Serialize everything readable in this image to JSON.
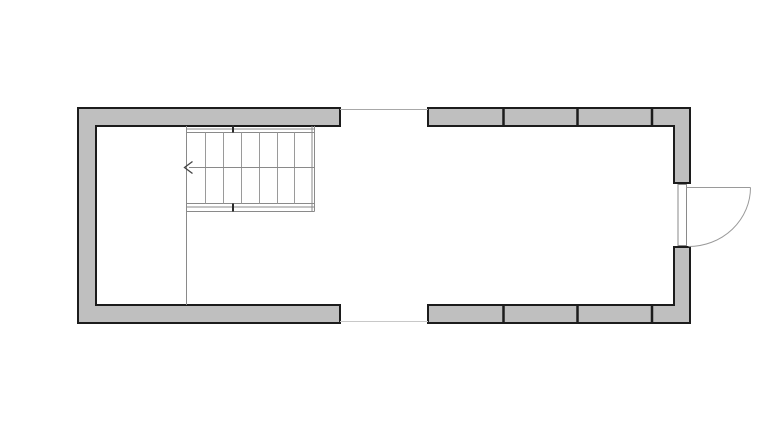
{
  "page": {
    "background": "#ffffff",
    "width": 768,
    "height": 431
  },
  "plan": {
    "name": "floor-plan-with-stair-and-entry-door",
    "viewbox": "0 0 768 431",
    "colors": {
      "wall_fill": "#bfbfbf",
      "wall_outline": "#1c1c1c",
      "stair_line": "#8a8a8a",
      "tread_line": "#9a9a9a",
      "door_line": "#9a9a9a",
      "opening_line_top": "#a8a8a8",
      "opening_line_bottom": "#c8c8c8",
      "tick": "#2a2a2a",
      "arrow": "#444444"
    },
    "summary": {
      "stair_treads": 7,
      "stair_direction": "arrow-pointing-left",
      "wall_panel_dividers_top": 3,
      "wall_panel_dividers_bottom": 3,
      "door": "right-wall-outward-swing-with-quarter-arc",
      "middle_wall_opening": "passage-between-left-and-right-sections"
    },
    "shapes": [
      {
        "kind": "path",
        "name": "wall-left-c-shape",
        "d": "M340,108 L78,108 L78,323 L340,323 L340,305 L96,305 L96,126 L340,126 Z",
        "fill": "#bfbfbf",
        "stroke": "#1c1c1c",
        "width": 2
      },
      {
        "kind": "path",
        "name": "wall-top-right-run",
        "d": "M428,108 L690,108 L690,183 L674,183 L674,126 L428,126 Z",
        "fill": "#bfbfbf",
        "stroke": "#1c1c1c",
        "width": 2
      },
      {
        "kind": "path",
        "name": "wall-bottom-right-run",
        "d": "M428,323 L690,323 L690,247 L674,247 L674,305 L428,305 Z",
        "fill": "#bfbfbf",
        "stroke": "#1c1c1c",
        "width": 2
      },
      {
        "kind": "line",
        "name": "wall-mullion-top-1",
        "x1": 503.5,
        "y1": 108,
        "x2": 503.5,
        "y2": 126,
        "stroke": "#1c1c1c",
        "width": 2.5
      },
      {
        "kind": "line",
        "name": "wall-mullion-top-2",
        "x1": 577.5,
        "y1": 108,
        "x2": 577.5,
        "y2": 126,
        "stroke": "#1c1c1c",
        "width": 2.5
      },
      {
        "kind": "line",
        "name": "wall-mullion-top-3",
        "x1": 652,
        "y1": 108,
        "x2": 652,
        "y2": 126,
        "stroke": "#1c1c1c",
        "width": 2.5
      },
      {
        "kind": "line",
        "name": "wall-mullion-bottom-1",
        "x1": 503.5,
        "y1": 305,
        "x2": 503.5,
        "y2": 323,
        "stroke": "#1c1c1c",
        "width": 2.5
      },
      {
        "kind": "line",
        "name": "wall-mullion-bottom-2",
        "x1": 577.5,
        "y1": 305,
        "x2": 577.5,
        "y2": 323,
        "stroke": "#1c1c1c",
        "width": 2.5
      },
      {
        "kind": "line",
        "name": "wall-mullion-bottom-3",
        "x1": 652,
        "y1": 305,
        "x2": 652,
        "y2": 323,
        "stroke": "#1c1c1c",
        "width": 2.5
      },
      {
        "kind": "line",
        "name": "opening-sill-line-top",
        "x1": 340,
        "y1": 109.5,
        "x2": 428,
        "y2": 109.5,
        "stroke": "#a8a8a8",
        "width": 1
      },
      {
        "kind": "line",
        "name": "opening-sill-line-bottom",
        "x1": 340,
        "y1": 321.5,
        "x2": 428,
        "y2": 321.5,
        "stroke": "#c8c8c8",
        "width": 1
      },
      {
        "kind": "line",
        "name": "stair-left-edge-and-partition-line",
        "x1": 186.5,
        "y1": 126,
        "x2": 186.5,
        "y2": 305,
        "stroke": "#8a8a8a",
        "width": 1
      },
      {
        "kind": "line",
        "name": "stair-right-edge-inner",
        "x1": 312,
        "y1": 126,
        "x2": 312,
        "y2": 211.5,
        "stroke": "#8a8a8a",
        "width": 1
      },
      {
        "kind": "line",
        "name": "stair-right-edge-outer",
        "x1": 314.5,
        "y1": 126,
        "x2": 314.5,
        "y2": 211.5,
        "stroke": "#8a8a8a",
        "width": 1
      },
      {
        "kind": "line",
        "name": "stair-top-stringer-outer",
        "x1": 186.5,
        "y1": 129,
        "x2": 314.5,
        "y2": 129,
        "stroke": "#8a8a8a",
        "width": 1
      },
      {
        "kind": "line",
        "name": "stair-top-stringer-inner",
        "x1": 186.5,
        "y1": 132.5,
        "x2": 314.5,
        "y2": 132.5,
        "stroke": "#8a8a8a",
        "width": 1
      },
      {
        "kind": "line",
        "name": "stair-bottom-stringer-inner",
        "x1": 186.5,
        "y1": 203.5,
        "x2": 314.5,
        "y2": 203.5,
        "stroke": "#8a8a8a",
        "width": 1
      },
      {
        "kind": "line",
        "name": "stair-bottom-stringer-outer",
        "x1": 186.5,
        "y1": 207,
        "x2": 314.5,
        "y2": 207,
        "stroke": "#8a8a8a",
        "width": 1
      },
      {
        "kind": "line",
        "name": "stair-bottom-edge",
        "x1": 186.5,
        "y1": 211.5,
        "x2": 314.5,
        "y2": 211.5,
        "stroke": "#8a8a8a",
        "width": 1
      },
      {
        "kind": "line",
        "name": "stair-tread-1",
        "x1": 205.5,
        "y1": 132.5,
        "x2": 205.5,
        "y2": 203.5,
        "stroke": "#9a9a9a",
        "width": 1
      },
      {
        "kind": "line",
        "name": "stair-tread-2",
        "x1": 223.5,
        "y1": 132.5,
        "x2": 223.5,
        "y2": 203.5,
        "stroke": "#9a9a9a",
        "width": 1
      },
      {
        "kind": "line",
        "name": "stair-tread-3",
        "x1": 241.5,
        "y1": 132.5,
        "x2": 241.5,
        "y2": 203.5,
        "stroke": "#9a9a9a",
        "width": 1
      },
      {
        "kind": "line",
        "name": "stair-tread-4",
        "x1": 259.5,
        "y1": 132.5,
        "x2": 259.5,
        "y2": 203.5,
        "stroke": "#9a9a9a",
        "width": 1
      },
      {
        "kind": "line",
        "name": "stair-tread-5",
        "x1": 277.5,
        "y1": 132.5,
        "x2": 277.5,
        "y2": 203.5,
        "stroke": "#9a9a9a",
        "width": 1
      },
      {
        "kind": "line",
        "name": "stair-tread-6",
        "x1": 294.5,
        "y1": 132.5,
        "x2": 294.5,
        "y2": 203.5,
        "stroke": "#9a9a9a",
        "width": 1
      },
      {
        "kind": "line",
        "name": "stair-walk-line",
        "x1": 189,
        "y1": 167.5,
        "x2": 314.5,
        "y2": 167.5,
        "stroke": "#8a8a8a",
        "width": 1
      },
      {
        "kind": "path",
        "name": "stair-direction-arrow-icon",
        "d": "M192.5,161.5 L184.5,167.5 L192.5,173.5",
        "fill": "none",
        "stroke": "#444444",
        "width": 1.3
      },
      {
        "kind": "line",
        "name": "stair-break-tick-top",
        "x1": 233,
        "y1": 125,
        "x2": 233,
        "y2": 132.5,
        "stroke": "#2a2a2a",
        "width": 2
      },
      {
        "kind": "line",
        "name": "stair-break-tick-bottom",
        "x1": 233,
        "y1": 203.5,
        "x2": 233,
        "y2": 211.5,
        "stroke": "#2a2a2a",
        "width": 2
      },
      {
        "kind": "rect",
        "name": "door-frame",
        "x": 678,
        "y": 184.5,
        "w": 8.5,
        "h": 61,
        "fill": "#ffffff",
        "stroke": "#8a8a8a",
        "width": 1
      },
      {
        "kind": "line",
        "name": "door-leaf-line",
        "x1": 686.5,
        "y1": 187.5,
        "x2": 750.5,
        "y2": 187.5,
        "stroke": "#9a9a9a",
        "width": 1
      },
      {
        "kind": "path",
        "name": "door-swing-arc",
        "d": "M750.5,187.5 A62,59 0 0 1 688.5,246.5",
        "fill": "none",
        "stroke": "#9a9a9a",
        "width": 1
      }
    ]
  }
}
